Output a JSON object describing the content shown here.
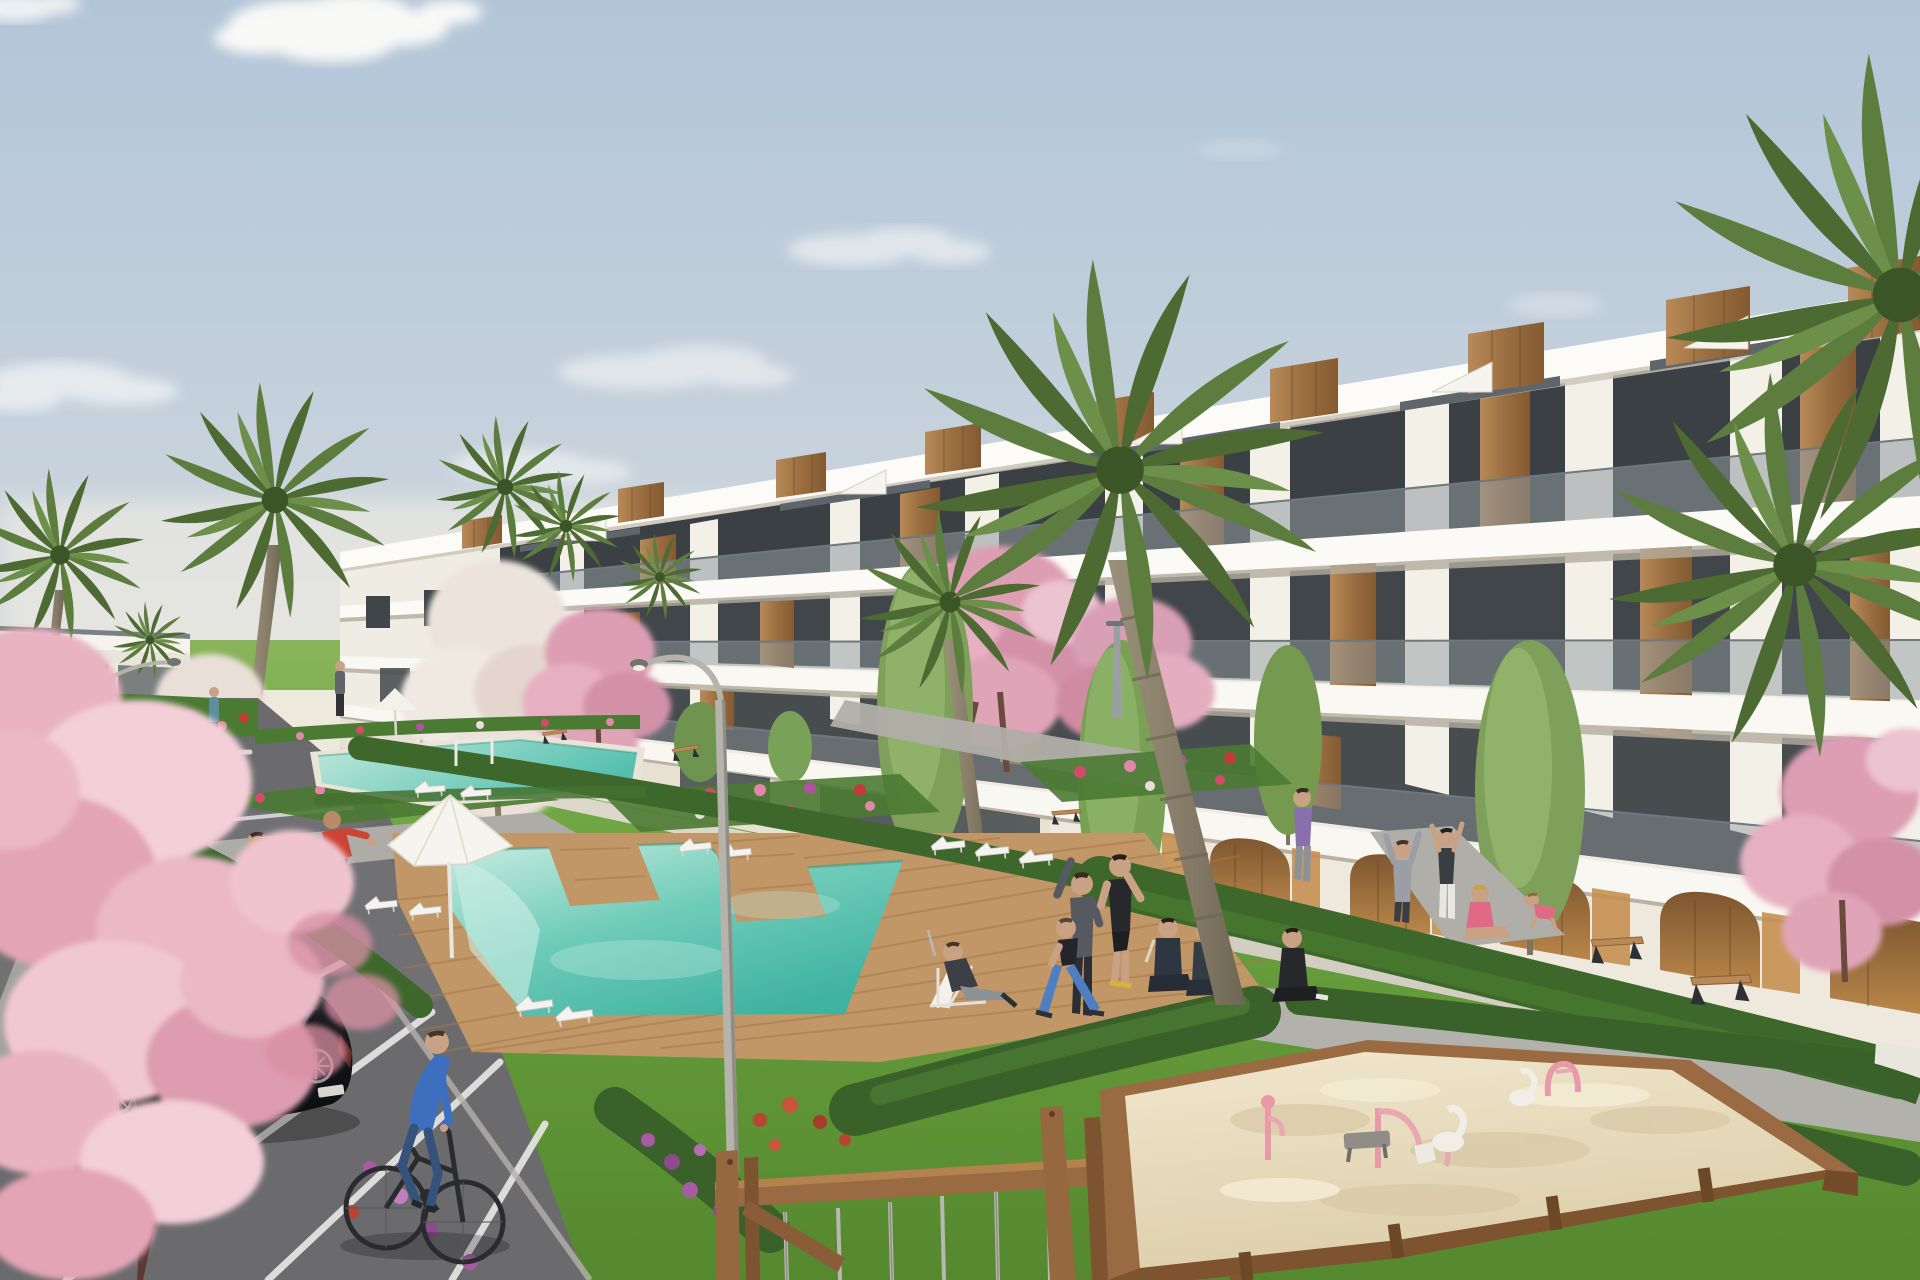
{
  "scene": {
    "title": "New-build Mediterranean apartment complex with communal pools and gardens",
    "type": "3D architectural rendering, daytime",
    "description": "Elevated view of a long terraced row of white modern apartments with timber accents and rooftop wooden volumes. Communal turquoise pools with timber decks and white sun loungers sit in landscaped lawns with palm trees, pink blossom trees and flower beds. A parking area at left holds a black hatchback and two dark sedans; a cyclist in blue rides past. People jog, stretch and relax on the grass. A timber sandbox with toys and a wooden swing frame fill the foreground right."
  },
  "palette": {
    "sky_top": "#b2c5d8",
    "sky_horizon": "#f4efe5",
    "cloud": "#fcfaf6",
    "building_white": "#f7f5ef",
    "building_shadow": "#ddd8cd",
    "window_glass": "#3a4044",
    "timber": "#a97e51",
    "arcade_ochre": "#c08a4e",
    "grass": "#6ba23f",
    "hedge": "#3e672c",
    "pool_light": "#b5e6da",
    "pool_deep": "#3fb2a0",
    "deck_wood": "#c29768",
    "path_gray": "#a8a6a1",
    "asphalt": "#6b6b6d",
    "sand": "#e9ddc1",
    "frame_wood": "#9a6b42",
    "blossom_pink": "#e9b3c2",
    "palm_green": "#5d7d3f",
    "car_black": "#17181b",
    "accent_red": "#cc4434",
    "accent_teal": "#57b3a4",
    "accent_blue": "#3d6fbe"
  },
  "objects": {
    "buildings": {
      "label": "terraced white apartment row",
      "visible_floors": 3,
      "features": [
        "rooftop timber box volumes",
        "roof stair parapets",
        "glass balustrades",
        "timber wall panels",
        "ground-floor arched arcade",
        "ochre recessed walls"
      ]
    },
    "pools": [
      {
        "label": "main tetris-shaped pool with timber deck"
      },
      {
        "label": "upper lap pool"
      }
    ],
    "umbrellas": [
      {
        "label": "white parasol by main pool"
      },
      {
        "label": "small white parasol"
      },
      {
        "label": "small red parasol (distant)"
      }
    ],
    "vehicles": [
      {
        "label": "black hatchback, parked"
      },
      {
        "label": "dark sedan, parked"
      },
      {
        "label": "dark sedan, edge of frame"
      },
      {
        "label": "bicycle with rider in blue"
      }
    ],
    "people": [
      "jogger in teal top",
      "jogger in pink top",
      "man in gray holding white ball",
      "man in red shirt reaching",
      "cyclist in blue",
      "man reclining on deck chair",
      "man stretching in gray",
      "man stretching in black",
      "woman lunging in blue leggings",
      "two seated people in track suits",
      "woman walking in purple",
      "person in gray with arms raised",
      "woman with arms raised",
      "woman seated in pink",
      "woman seated in black",
      "child in pink crawling",
      "two tiny distant figures"
    ],
    "street_furniture": [
      "curved street lamp",
      "small distant street lamp",
      "timber slat benches",
      "white sun loungers"
    ],
    "playground": {
      "sandbox": "timber-framed sandbox with pink crane, spring swans and arch toy",
      "swing": "wooden swing frame with steel cables and ladder"
    },
    "vegetation": [
      "fan palms",
      "pink blossom trees",
      "white blossom trees",
      "columnar green trees",
      "clipped hedges",
      "mixed flower beds"
    ]
  }
}
